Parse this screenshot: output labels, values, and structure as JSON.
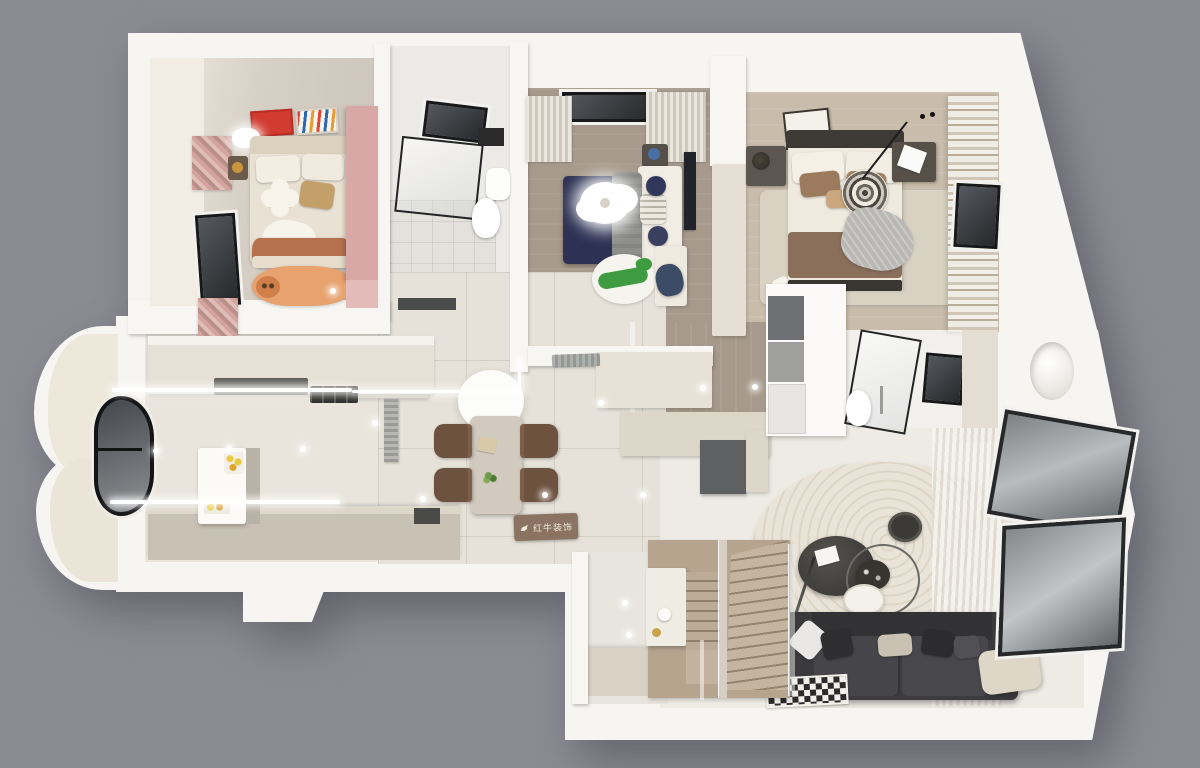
{
  "watermark": {
    "text": "红牛装饰",
    "icon": "bull-icon",
    "plate_color": "#8a7360",
    "text_color": "#efe8da"
  },
  "palette": {
    "background": "#8b8b93",
    "outer_wall": "#f6f5f2",
    "marble_floor": "#e6e2d9",
    "wood_floor_dark": "#a79a8c",
    "wood_floor_light": "#c9bcab",
    "kids_floor": "#d4cdc3",
    "kitchen_floor": "#e9e5dc",
    "living_floor": "#edebe4",
    "cabinet_cream": "#ddd7ca",
    "cabinet_taupe": "#c9c2b4",
    "sofa": "#3c3c3f",
    "navy_bed": "#2d3254",
    "pink_wardrobe": "#d8a8a7",
    "terracotta_blanket": "#b5714e",
    "kids_rug": "#e8a26e",
    "croc_green": "#3f9b3f",
    "master_blanket": "#8a6f5b",
    "poster_red": "#d23b30",
    "chair_brown": "#6e5240",
    "table_marble": "#d2cabf",
    "pendant": "#fcfcfa",
    "stairs_wood": "#b6a48f",
    "window_glass": "#2a2c2f",
    "rug_ring_light": "#eae4d8",
    "rug_ring_dark": "#ddd5c6"
  }
}
